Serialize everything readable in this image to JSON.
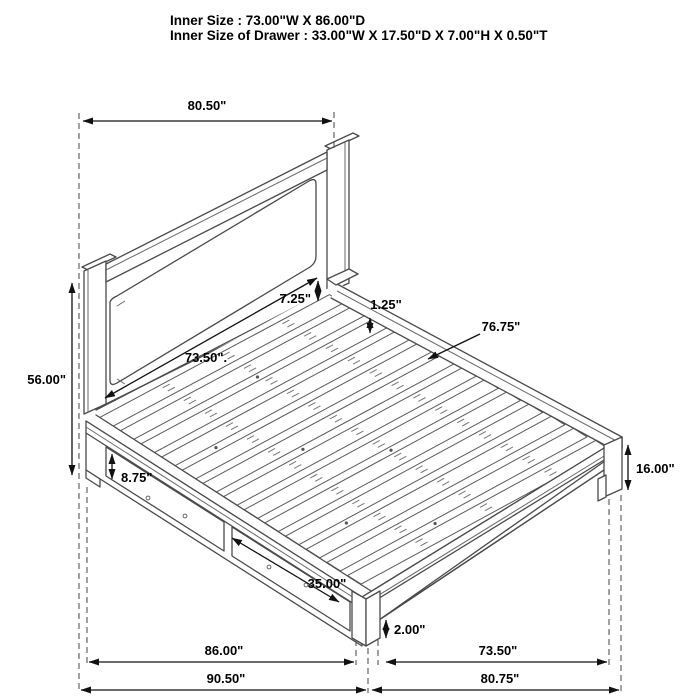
{
  "title": {
    "line1": "Inner Size : 73.00\"W X 86.00\"D",
    "line2": "Inner Size of Drawer : 33.00\"W X 17.50\"D X 7.00\"H X 0.50\"T"
  },
  "dimensions": {
    "headboard_width": "80.50\"",
    "headboard_height": "56.00\"",
    "headboard_panel_width": "73.50\".",
    "panel_to_rail_gap": "7.25\"",
    "slat_thickness": "1.25\"",
    "inner_rail_length": "76.75\"",
    "footboard_post_height": "16.00\"",
    "drawer_face_height": "8.75\"",
    "drawer_front_width": "35.00\"",
    "bottom_clearance": "2.00\"",
    "base_side_length": "86.00\"",
    "foot_inner_width": "73.50\"",
    "overall_side_length": "90.50\"",
    "overall_foot_width": "80.75\""
  },
  "colors": {
    "background": "#ffffff",
    "line_art": "#4a4a4a",
    "dimension_lines": "#111111",
    "text": "#000000"
  }
}
